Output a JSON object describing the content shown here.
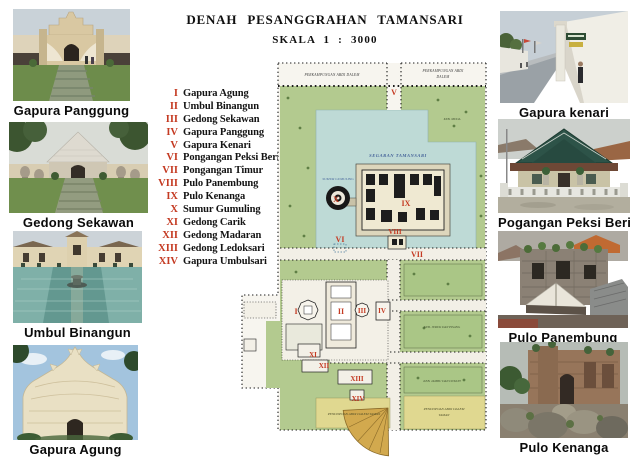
{
  "header": {
    "title": "DENAH PESANGGRAHAN TAMANSARI",
    "scale": "SKALA 1 : 3000"
  },
  "legend": {
    "items": [
      {
        "numeral": "I",
        "name": "Gapura Agung"
      },
      {
        "numeral": "II",
        "name": "Umbul Binangun"
      },
      {
        "numeral": "III",
        "name": "Gedong Sekawan"
      },
      {
        "numeral": "IV",
        "name": "Gapura Panggung"
      },
      {
        "numeral": "V",
        "name": "Gapura Kenari"
      },
      {
        "numeral": "VI",
        "name": "Pongangan Peksi Beri"
      },
      {
        "numeral": "VII",
        "name": "Pongangan Timur"
      },
      {
        "numeral": "VIII",
        "name": "Pulo Panembung"
      },
      {
        "numeral": "IX",
        "name": "Pulo Kenanga"
      },
      {
        "numeral": "X",
        "name": "Sumur Gumuling"
      },
      {
        "numeral": "XI",
        "name": "Gedong Carik"
      },
      {
        "numeral": "XII",
        "name": "Gedong Madaran"
      },
      {
        "numeral": "XIII",
        "name": "Gedong Ledoksari"
      },
      {
        "numeral": "XIV",
        "name": "Gapura Umbulsari"
      }
    ]
  },
  "photos": {
    "left": [
      {
        "caption": "Gapura Panggung"
      },
      {
        "caption": "Gedong Sekawan"
      },
      {
        "caption": "Umbul Binangun"
      },
      {
        "caption": "Gapura Agung"
      }
    ],
    "right": [
      {
        "caption": "Gapura kenari"
      },
      {
        "caption": "Pogangan Peksi Beri"
      },
      {
        "caption": "Pulo Panembung"
      },
      {
        "caption": "Pulo Kenanga"
      }
    ]
  },
  "map": {
    "labels": {
      "lake": "SEGARAN TAMANSARI",
      "well": "SUMUR GUMULING",
      "kampung_left": "PERKAMPUNGAN ABDI DALEM",
      "kampung_right_1": "PERKAMPUNGAN ABDI",
      "kampung_right_2": "DALEM",
      "garden_top": "KEB. MUDA",
      "garden_mid": "KEB. JERUK DAN PISANG",
      "garden_low": "KEB. JAMBU DAN DUKUH",
      "pendopo_left": "PENDOPOAN ABDI DALEM TAMAN",
      "pendopo_right_1": "PENDOPOAN ABDI DALEM",
      "pendopo_right_2": "TAMAN"
    },
    "colors": {
      "marker_red": "#c43a22",
      "lake_blue": "#bedad6",
      "map_green": "#b3ca8f",
      "pendopo_yellow": "#e0d890",
      "fan_gold": "#d2a94e"
    }
  }
}
